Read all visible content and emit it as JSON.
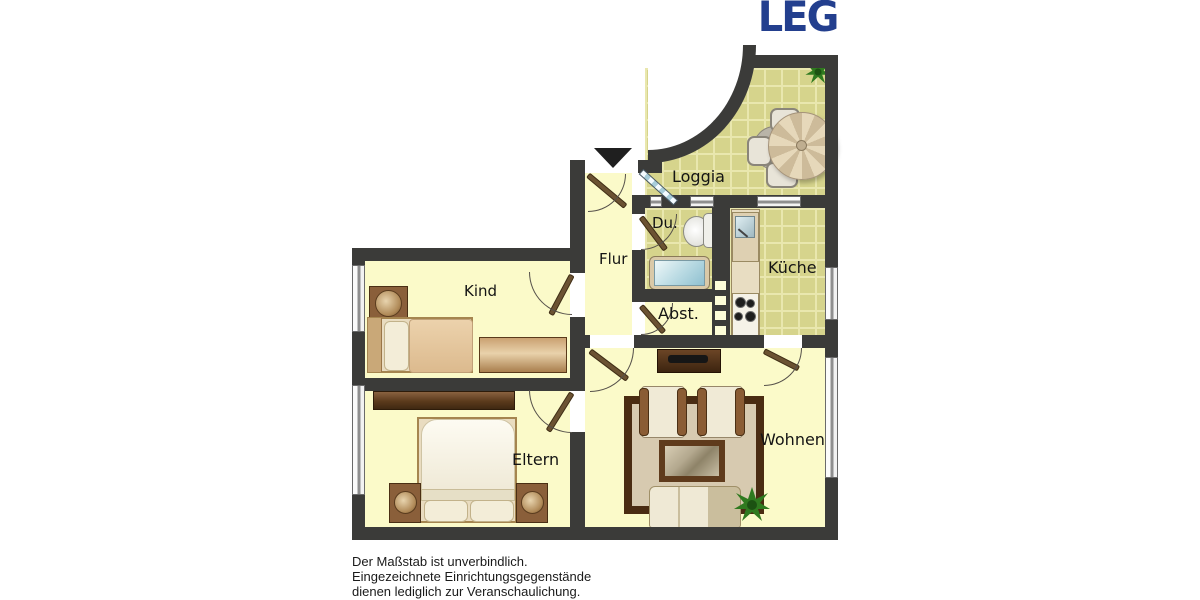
{
  "logo": {
    "text": "LEG"
  },
  "rooms": {
    "loggia": "Loggia",
    "dusche": "Du.",
    "kueche": "Küche",
    "flur": "Flur",
    "kind": "Kind",
    "abstellraum": "Abst.",
    "eltern": "Eltern",
    "wohnen": "Wohnen"
  },
  "disclaimer": {
    "line1": "Der Maßstab ist unverbindlich.",
    "line2": "Eingezeichnete Einrichtungsgegenstände",
    "line3": "dienen lediglich zur Veranschaulichung."
  },
  "colors": {
    "wall": "#3b3b39",
    "room_floor": "#fbfac9",
    "tile_floor": "#d6d48c",
    "tile_grout": "#e9e7ae",
    "logo_navy": "#233f8e",
    "door_wood": "#6b5232"
  }
}
